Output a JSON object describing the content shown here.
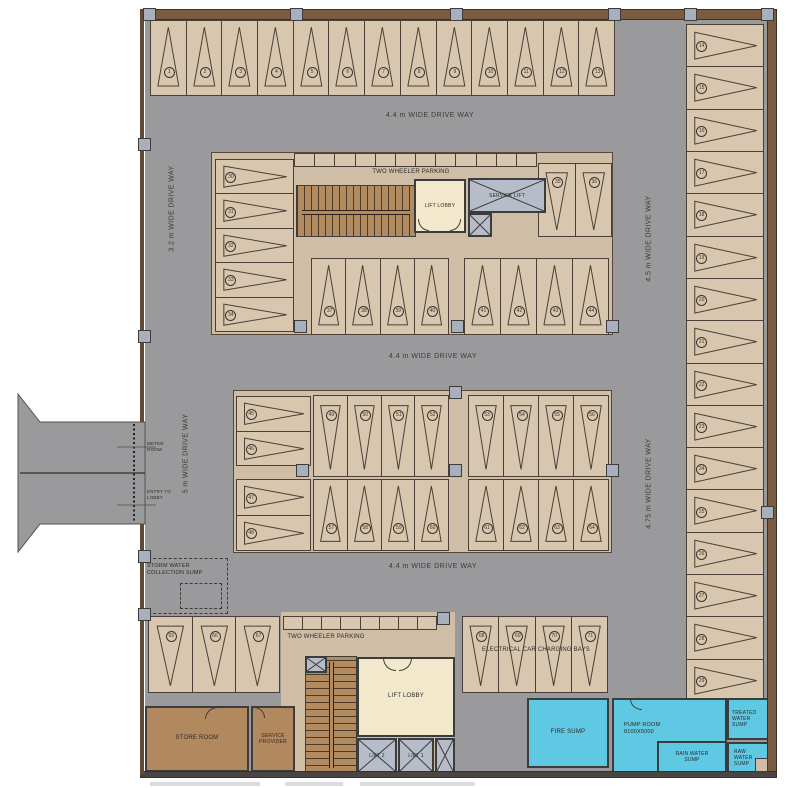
{
  "colors": {
    "driveway": "#9a9a9c",
    "stall": "#d9c6ae",
    "block": "#cfbda6",
    "wall": "#7a5c40",
    "stair": "#b28a60",
    "roomBrown": "#b2885f",
    "lobby": "#f2e9cd",
    "lift": "#b6bdc8",
    "sump": "#5fc8e2",
    "line": "#4a4038",
    "column": "#a9b0bd"
  },
  "labels": {
    "driveway_top": "4.4 m WIDE DRIVE WAY",
    "driveway_mid": "4.4 m WIDE DRIVE WAY",
    "driveway_bottom": "4.4 m WIDE DRIVE WAY",
    "driveway_left_upper": "3.2 m WIDE DRIVE WAY",
    "driveway_left_lower": "5 m WIDE DRIVE WAY",
    "driveway_right_upper": "4.5 m WIDE DRIVE WAY",
    "driveway_right_lower": "4.75 m WIDE DRIVE WAY"
  },
  "rooms": {
    "two_wheeler_upper": "TWO WHEELER PARKING",
    "two_wheeler_lower": "TWO WHEELER PARKING",
    "lift_lobby_upper": "LIFT LOBBY",
    "service_lift": "SERVICE LIFT",
    "storm_sump": "STORM WATER COLLECTION SUMP",
    "meter_room": "METER ROOM",
    "entry_lobby": "ENTRY TO LOBBY",
    "store_room": "STORE ROOM",
    "service_provider": "SERVICE PROVIDER",
    "lift_lobby_lower": "LIFT LOBBY",
    "lift_2": "LIFT 2",
    "lift_1": "LIFT 1",
    "ev_bays": "ELECTRICAL CAR CHARGING BAYS",
    "fire_sump": "FIRE SUMP",
    "pump_room": "PUMP ROOM",
    "pump_room_size": "8100X5000",
    "rain_water_sump": "RAIN WATER SUMP",
    "treated_water_sump": "TREATED WATER SUMP",
    "raw_water_sump": "RAW WATER SUMP"
  },
  "strips": {
    "upper": 12,
    "lower": 8
  },
  "stall_groups": {
    "top_row": {
      "start": 1,
      "count": 13,
      "dir": "up",
      "layout": "row"
    },
    "right_col": {
      "start": 14,
      "count": 16,
      "dir": "right",
      "layout": "col"
    },
    "um_left": {
      "start": 30,
      "count": 5,
      "dir": "right",
      "layout": "col"
    },
    "um_top_right": {
      "start": 35,
      "count": 2,
      "dir": "down",
      "layout": "row"
    },
    "um_bottom_a": {
      "start": 37,
      "count": 4,
      "dir": "up",
      "layout": "row"
    },
    "um_bottom_b": {
      "start": 41,
      "count": 4,
      "dir": "up",
      "layout": "row"
    },
    "mi_left_top": {
      "start": 45,
      "count": 2,
      "dir": "right",
      "layout": "col"
    },
    "mi_left_bottom": {
      "start": 47,
      "count": 2,
      "dir": "right",
      "layout": "col"
    },
    "mi_top_a": {
      "start": 49,
      "count": 4,
      "dir": "down",
      "layout": "row"
    },
    "mi_top_b": {
      "start": 53,
      "count": 4,
      "dir": "down",
      "layout": "row"
    },
    "mi_bot_a": {
      "start": 57,
      "count": 4,
      "dir": "up",
      "layout": "row"
    },
    "mi_bot_b": {
      "start": 61,
      "count": 4,
      "dir": "up",
      "layout": "row"
    },
    "bl_left": {
      "start": 65,
      "count": 3,
      "dir": "down",
      "layout": "row"
    },
    "ev_bays": {
      "start": 68,
      "count": 4,
      "dir": "down",
      "layout": "row"
    }
  }
}
